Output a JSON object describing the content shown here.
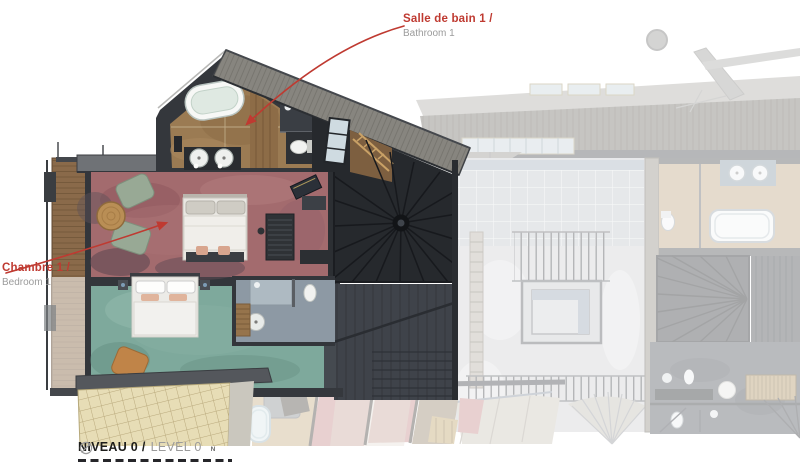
{
  "annotations": {
    "bathroom1": {
      "label_fr": "Salle de bain 1 /",
      "label_en": "Bathroom 1"
    },
    "bedroom1": {
      "label_fr": "Chambre 1 /",
      "label_en": "Bedroom 1"
    }
  },
  "footer": {
    "level_fr": "NIVEAU 0 /",
    "level_en": "LEVEL 0",
    "compass": "N"
  },
  "colors": {
    "annotation_red": "#bf3a31",
    "annotation_gray": "#9b9b9b",
    "footer_text": "#1d1d1b",
    "wall_dark": "#33363b",
    "roof_gray": "#87857f",
    "bathroom_floor": "#9b7b53",
    "bedroom_carpet": "#a36b6e",
    "lounge_carpet": "#7ea99c",
    "balcony_wood": "#8a6a4a",
    "shingle_roof": "#e7ddb6",
    "dim_tile": "#caccd0"
  },
  "plan_features": [
    "bathtub",
    "double-sink-vanity",
    "toilet",
    "shower",
    "double-bed",
    "armchair",
    "side-table",
    "wardrobe",
    "balcony",
    "conical-roof",
    "staircase",
    "stairwell-railing",
    "roof-shingles",
    "chimney",
    "skylight",
    "compass-north"
  ]
}
